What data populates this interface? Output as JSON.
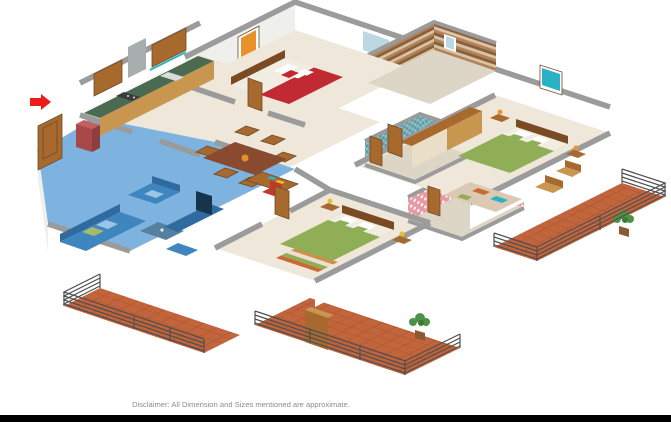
{
  "scene": {
    "type": "3d-isometric-floor-plan-render",
    "disclaimer": "Disclaimer: All Dimension and Sizes mentioned are approximate.",
    "highlighted_room": "living-room",
    "rooms": [
      {
        "id": "entrance-foyer"
      },
      {
        "id": "living-room",
        "highlighted": true
      },
      {
        "id": "kitchen"
      },
      {
        "id": "dining-area"
      },
      {
        "id": "study-nook"
      },
      {
        "id": "bedroom-1"
      },
      {
        "id": "bedroom-2"
      },
      {
        "id": "master-bedroom"
      },
      {
        "id": "bathroom-1"
      },
      {
        "id": "bathroom-2"
      },
      {
        "id": "bathroom-3"
      },
      {
        "id": "balcony-left"
      },
      {
        "id": "balcony-center"
      },
      {
        "id": "balcony-right"
      }
    ]
  },
  "palette": {
    "wall_top": "#9b9b9b",
    "wall_face": "#ffffff",
    "wall_shade": "#efefec",
    "floor": "#efe8da",
    "floor_tile": "#ddd6c6",
    "blue_overlay": "#7db3de",
    "blue_sofa": "#3f86bf",
    "blue_dark": "#2f6b9e",
    "blue_light": "#9cc4e4",
    "terracotta": "#c2653c",
    "terracotta_line": "#8f4527",
    "railing": "#4f4f4f",
    "wood": "#a8692f",
    "wood_light": "#c9964f",
    "wood_dark": "#7a4a22",
    "cream_panel": "#e9dfc9",
    "counter_green": "#4a6b52",
    "fridge_red": "#a84848",
    "bed_red": "#c12a33",
    "bed_green": "#8fae56",
    "linen": "#f2ede2",
    "tile_brown1": "#b08358",
    "tile_brown2": "#8a5f3d",
    "tile_brown3": "#d8c3a5",
    "tile_teal1": "#8fc0c6",
    "tile_teal2": "#5f9aa4",
    "tile_pink": "#e89aa4",
    "art_teal": "#29b2c6",
    "art_orange": "#e8912b",
    "lamp_orange": "#e8952a",
    "lamp_yellow": "#e3c32a",
    "plant": "#4e9345",
    "pot": "#8a5a33",
    "glass": "#bcd8e2",
    "text_muted": "#8c8c8c",
    "bottom_bar": "#000000",
    "arrow_red": "#ed1c1c"
  }
}
